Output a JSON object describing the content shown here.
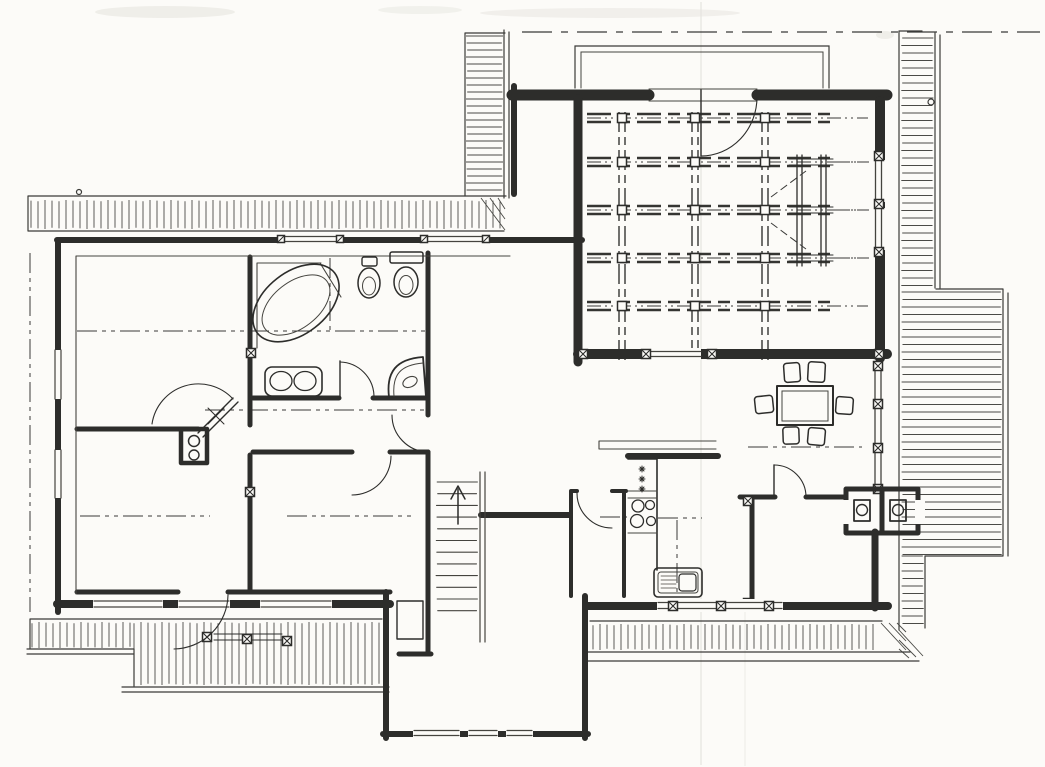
{
  "meta": {
    "kind": "hand-drawn architectural floor plan sketch",
    "media": "black ink line drawing on white paper",
    "visible_text": "none",
    "width_px": 1045,
    "height_px": 767
  },
  "palette": {
    "paper": "#fcfbf8",
    "ink": "#2d2d2b",
    "light_ink": "#45443f",
    "smudge": "#e9e8e3"
  },
  "labels": {
    "canvas": "floor plan sketch",
    "paper_marks": "paper smudges and fold crease",
    "decks": "hatched terrace and deck walkways",
    "deck_top": "upper terrace with plank hatching",
    "deck_right": "right side deck with plank hatching",
    "deck_bottom": "lower balcony bands with railing",
    "walls": "thick ink walls of the house",
    "windows": "glazed openings with double lines and post markers",
    "doors": "door leaves with quarter-circle swing arcs",
    "diagonal_door": "corner door set in diagonal wall with cross mark",
    "stair": "straight staircase with treads and up arrow",
    "beam_grid": "exposed ceiling beam grid of large room",
    "section_lines": "dash-dot section and axis lines",
    "bathtub": "corner bathtub",
    "bidet": "bidet",
    "toilet": "toilet with cistern",
    "vanity": "double washbasin vanity",
    "shower": "corner shower with curved front",
    "fireplace": "wood stove with two hotplates",
    "chimney": "double chimney flue niches with round flues",
    "kitchen_counter": "kitchen counter run",
    "freezer": "appliance marked with three asterisks",
    "cooktop": "four burner cooktop",
    "kitchen_sink": "kitchen sink with drainboard",
    "pass_counter": "open pass-through counter",
    "dining_table": "rectangular dining table",
    "dining_chairs": "six dining chairs",
    "cupboard": "built-in cupboard",
    "dormer": "roof opening outline above large room"
  },
  "inventory": {
    "rooms_count": 8,
    "door_swings": 9,
    "stair_treads": 12,
    "dining_chairs": 6,
    "cooktop_burners": 4,
    "chimney_flues": 2,
    "beam_grid": {
      "vertical_beams": 3,
      "horizontal_rows": 5
    }
  }
}
